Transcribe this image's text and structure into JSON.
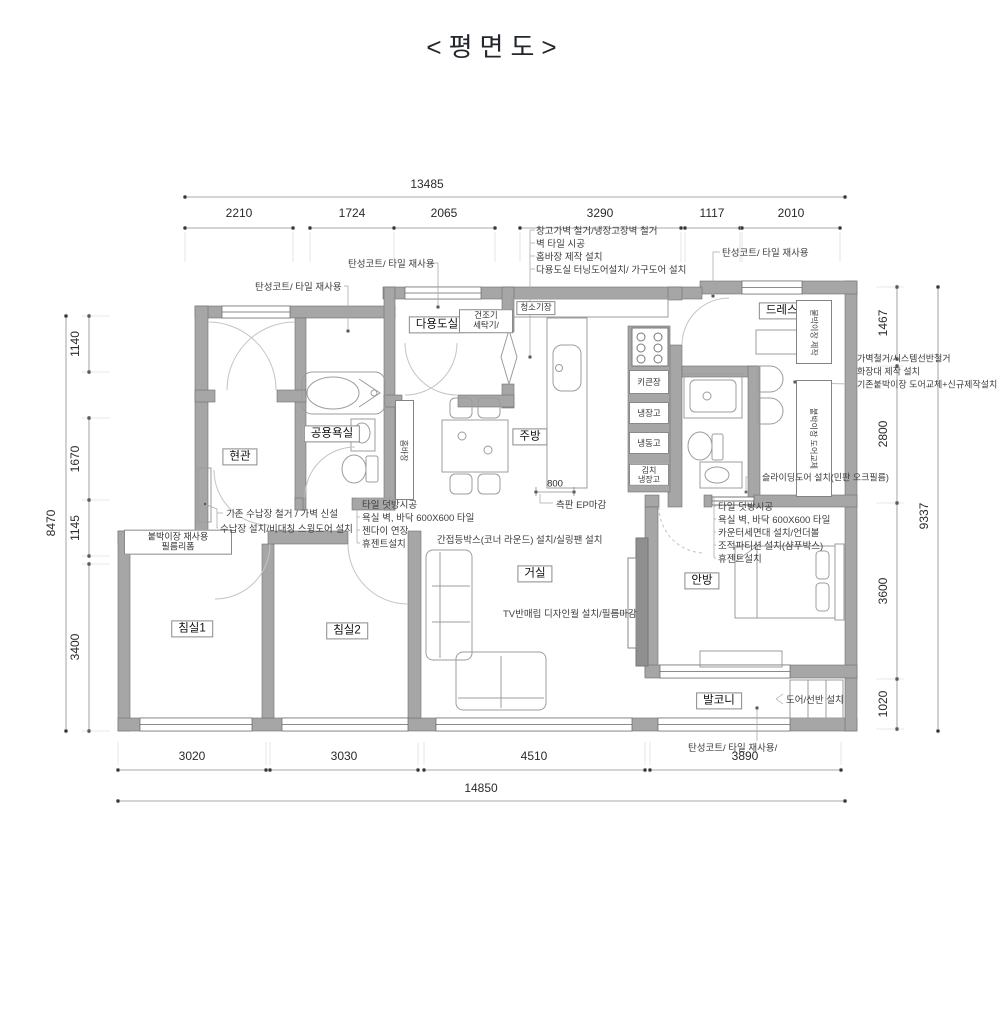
{
  "title": "<평면도>",
  "colors": {
    "wall_fill": "#a6a6a6",
    "marker_magenta": "#ec008c",
    "line_gray": "#8c8c8c"
  },
  "dimensions": {
    "top_total": "13485",
    "top_segments": [
      "2210",
      "1724",
      "2065",
      "3290",
      "1117",
      "2010"
    ],
    "bottom_segments": [
      "3020",
      "3030",
      "4510",
      "3890"
    ],
    "bottom_total": "14850",
    "left_total": "8470",
    "left_segments": [
      "1140",
      "1670",
      "1145",
      "3400"
    ],
    "right_segments": [
      "1467",
      "2800",
      "3600",
      "1020"
    ],
    "right_total": "9337",
    "island_width": "800"
  },
  "rooms": {
    "utility": "다용도실",
    "entrance": "현관",
    "common_bath": "공용욕실",
    "kitchen": "주방",
    "living": "거실",
    "bedroom1": "침실1",
    "bedroom2": "침실2",
    "master": "안방",
    "balcony": "발코니",
    "dressroom": "드레스룸"
  },
  "fixtures": {
    "dryer_washer": "건조기\n세탁기/",
    "vacuum_closet": "청소기장",
    "tall_cabinet": "키큰장",
    "fridge": "냉장고",
    "freezer": "냉동고",
    "kimchi_fridge": "김치\n냉장고",
    "home_bar": "홈바장",
    "closet_make": "붙박이장 제작",
    "closet_door_change": "붙박이장 도어교체",
    "wardrobe_reuse": "붙박이장 재사용\n필름리폼"
  },
  "annotations": {
    "elastic_coat": "탄성코트/ 타일 재사용",
    "elastic_coat_slash": "탄성코트/ 타일 재사용/",
    "top_center": [
      "창고가벽 철거/냉장고장벽 철거",
      "벽 타일 시공",
      "홈바장 제작 설치",
      "다용도실 터닝도어설치/ 가구도어 설치"
    ],
    "right_list": [
      "가벽철거/시스템선반철거",
      "화장대 제작 설치",
      "기존붙박이장 도어교체+신규제작설치"
    ],
    "entrance_list": [
      "기존 수납장 철거 / 가벽 신설",
      "수납장 설치/비대칭 스윙도어 설치"
    ],
    "common_bath_list": [
      "타일 덧방시공",
      "욕실 벽, 바닥 600X600 타일",
      "젠다이 연장",
      "휴젠트설치"
    ],
    "master_bath_list": [
      "타일 덧방시공",
      "욕실 벽, 바닥 600X600 타일",
      "카운터세면대 설치/언더볼",
      "조적파티션 설치(샴푸박스)",
      "휴젠트설치"
    ],
    "sliding_door": "슬라이딩도어 설치(민판 오크필름)",
    "ceiling": "간접등박스(코너 라운드) 설치/실링팬 설치",
    "tv_wall": "TV반매립 디자인월 설치/필름마감",
    "balcony_door": "도어/선반 설치",
    "ep_finish": "측판 EP마감"
  }
}
